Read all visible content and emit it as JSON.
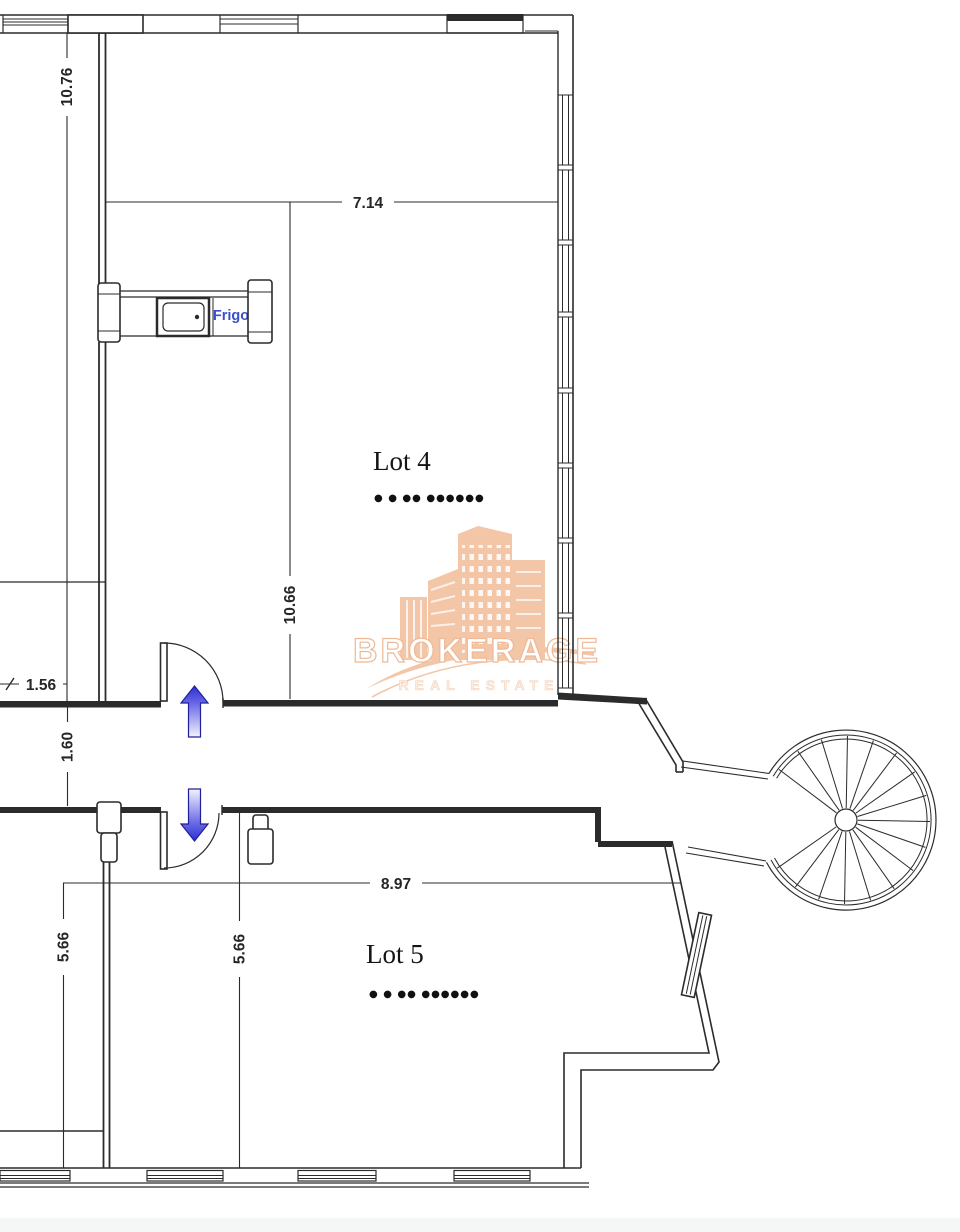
{
  "lots": {
    "lot4": {
      "label": "Lot 4",
      "dots": "● ● ●●  ●●●●●●"
    },
    "lot5": {
      "label": "Lot 5",
      "dots": "● ● ●●  ●●●●●●"
    }
  },
  "dimensions": {
    "left_height": "10.76",
    "lot4_width": "7.14",
    "lot4_height": "10.66",
    "entry_width": "1.56",
    "corridor_width": "1.60",
    "lot5_width": "8.97",
    "lot5_height_left": "5.66",
    "lot5_height_mid": "5.66"
  },
  "kitchen": {
    "fridge_label": "Frigo"
  },
  "watermark": {
    "title": "BROKERAGE",
    "subtitle": "REAL ESTATE"
  },
  "colors": {
    "line": "#2b2b2b",
    "dimension_text": "#262626",
    "fridge_text": "#3b4fc6",
    "arrow_blue": "#2e2ed6",
    "watermark_orange": "#f2b893"
  }
}
